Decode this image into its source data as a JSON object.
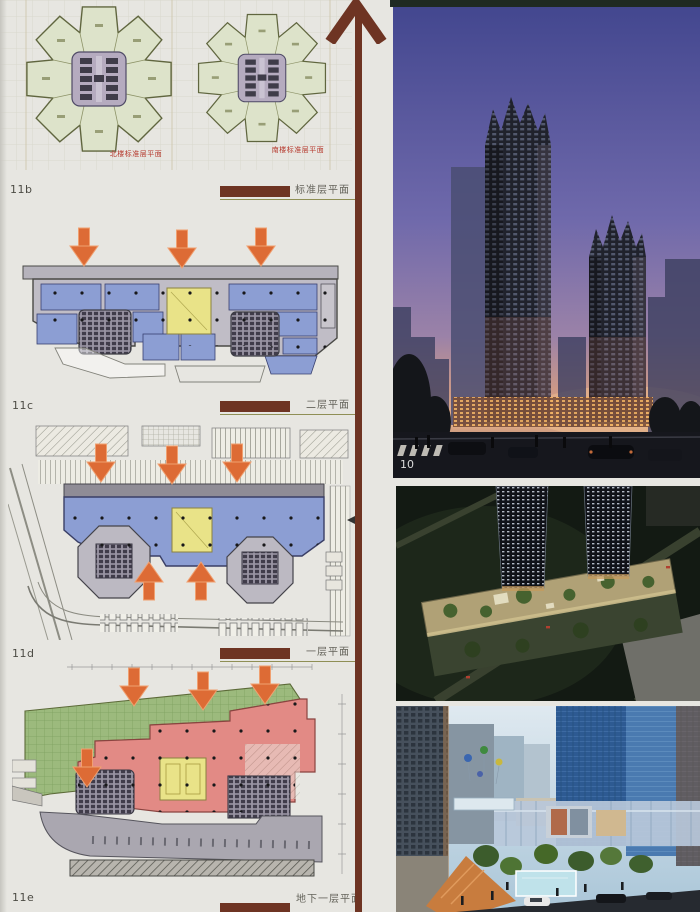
{
  "left_panel": {
    "plan_captions": {
      "north": "北楼标准层平面",
      "south": "南楼标准层平面"
    },
    "sections": [
      {
        "index": "11b",
        "caption": "标准层平面"
      },
      {
        "index": "11c",
        "caption": "二层平面"
      },
      {
        "index": "11d",
        "caption": "一层平面"
      },
      {
        "index": "11e",
        "caption": "地下一层平面"
      }
    ]
  },
  "right_panel": {
    "photo_number": "10"
  },
  "palette": {
    "caption_bar_brown": "#6e3423",
    "timeline_brown": "#6e3423",
    "arrow_orange": "#dd6b35",
    "plan_label_red": "#b5372b",
    "petal_green": "#dde3ca",
    "core_purple": "#b5abbf",
    "room_blue": "#8c9ed3",
    "atrium_yellow": "#e9e388",
    "basement_pink": "#e28a85",
    "landscape_green": "#9cba7d",
    "page_background": "#e7e6e1"
  }
}
